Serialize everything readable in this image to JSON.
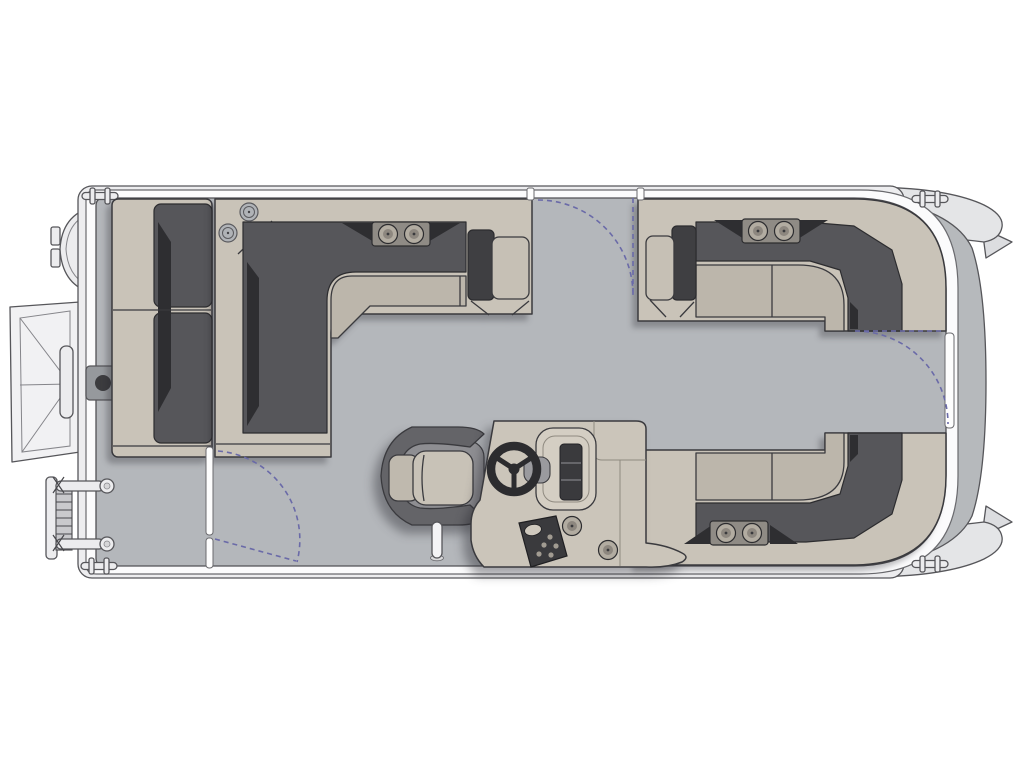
{
  "meta": {
    "description": "Top-down floor plan diagram of a pontoon boat, bow to the right, stern to the left",
    "visible_text": "none"
  },
  "colors": {
    "page_bg": "#ffffff",
    "hull": "#ededef",
    "rim": "#fbfbfc",
    "deck": "#b4b7bb",
    "bow_platform": "#b6b9bc",
    "pontoon_nose": "#e4e5e7",
    "metal_light": "#ececee",
    "metal_mid": "#c9c9cc",
    "base_light": "#c9c3b8",
    "cushion": "#bcb6ab",
    "cushion_pad": "#c6c0b5",
    "dark_band": "#56565a",
    "black_accent": "#2e2e31",
    "end_dark": "#3f3f42",
    "plate": "#8f8b85",
    "cup_outer": "#b2aca1",
    "cup_inner": "#8d877f",
    "console": "#cbc5ba",
    "windscreen": "#d4cec3",
    "panel_dark": "#3a3a3d",
    "chair_back": "#646468",
    "chair_shell": "#8e8e92",
    "chair_cushion": "#c8c2b7",
    "fitting": "#96999d",
    "fitting_dot": "#3c3c3f",
    "arc": "#6a6aa8",
    "stroke_dark": "#3a3a3e",
    "stroke_mid": "#56565a"
  },
  "components": {
    "hull": {
      "deck_floor": "open gray deck",
      "deck_rim": "white rub-rail band",
      "bow_platform": "gray bow deck extension",
      "pontoon_noses": 2,
      "pontoon_fins": 2
    },
    "gates": [
      {
        "name": "port-side-gate",
        "location": "top edge between lounges",
        "swing": "inward, dashed arc"
      },
      {
        "name": "bow-gate",
        "location": "right edge between bow lounges",
        "swing": "inward, dashed arc"
      },
      {
        "name": "starboard-side-gate",
        "location": "bottom-left of deck",
        "swing": "inward, dashed arc"
      }
    ],
    "seating": [
      {
        "name": "stern-chaise-lounge",
        "position": "stern (left), facing bow",
        "cushions": 2
      },
      {
        "name": "port-l-lounge",
        "position": "port forward (top-left)",
        "cup_holders": 2,
        "speaker_grilles": 2,
        "end_armrest": true
      },
      {
        "name": "starboard-bow-l-lounge",
        "position": "bow (top-right)",
        "cup_holders": 2,
        "end_armrest": true
      },
      {
        "name": "starboard-aft-bench",
        "position": "bottom-right",
        "cup_holders": 2,
        "end_armrest": true
      },
      {
        "name": "captains-chair",
        "position": "helm, facing bow",
        "type": "swivel bucket seat"
      }
    ],
    "helm": {
      "console": "helm-console",
      "steering_wheel": true,
      "windscreen": true,
      "instrument_panel": true,
      "switch_panel": true,
      "cup_holders": 2
    },
    "stern_equipment": {
      "outboard_motor": true,
      "boarding_ramp": true,
      "ramp_grab_handle": true,
      "telescoping_ladder": true,
      "deck_fitting": true
    },
    "hardware": {
      "mooring_cleats": 4,
      "ski_tow_pylon": true
    }
  }
}
